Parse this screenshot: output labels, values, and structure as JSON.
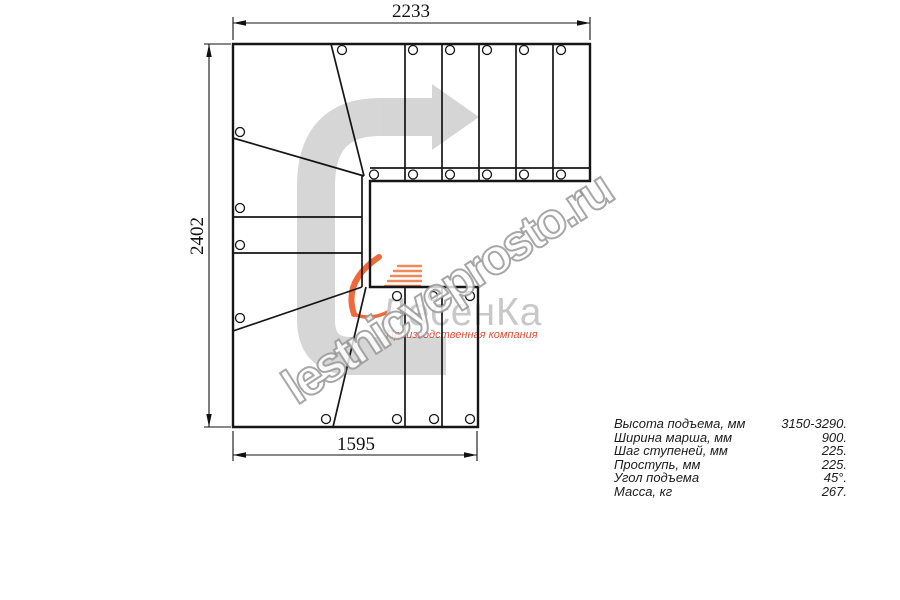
{
  "drawing": {
    "title": "L-shaped staircase plan view",
    "dimensions": {
      "top": "2233",
      "left": "2402",
      "bottom": "1595"
    }
  },
  "watermark": {
    "text": "lestnicyeprosto.ru"
  },
  "logo": {
    "title": "ЛесенКа",
    "subtitle": "Производственная компания",
    "flame_color": "#ee6a3c",
    "stripe_color": "#f0885a",
    "title_color": "#c8c8c8",
    "subtitle_color": "#dd4f38"
  },
  "specs": {
    "rows": [
      {
        "label": "Высота подъема, мм",
        "value": "3150-3290."
      },
      {
        "label": "Ширина марша, мм",
        "value": "900."
      },
      {
        "label": "Шаг ступеней, мм",
        "value": "225."
      },
      {
        "label": "Проступь, мм",
        "value": "225."
      },
      {
        "label": "Угол подъема",
        "value": "45°."
      },
      {
        "label": "Масса, кг",
        "value": "267."
      }
    ]
  },
  "colors": {
    "line": "#161616",
    "dimension": "#111111",
    "route_arrow_gray": "#d6d6d6",
    "background": "#ffffff"
  }
}
